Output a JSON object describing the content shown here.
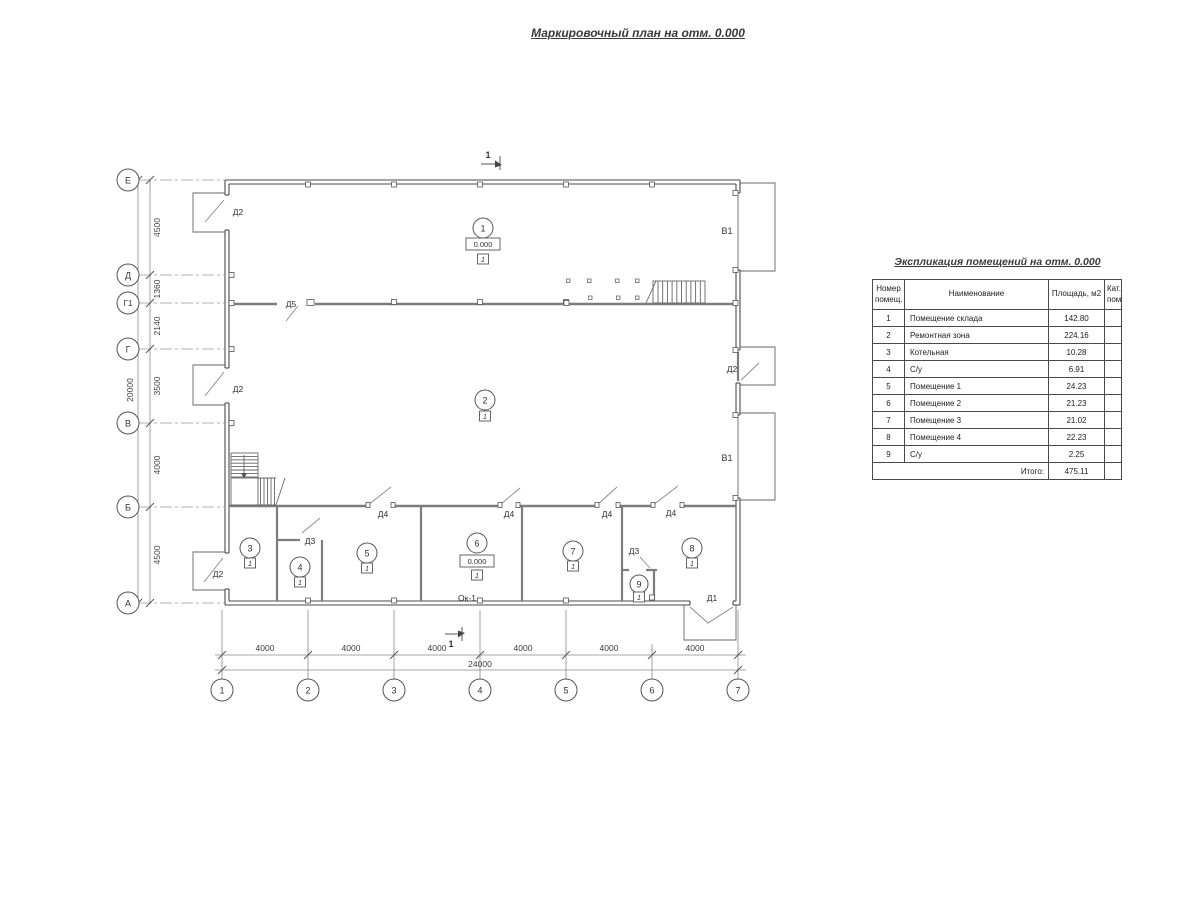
{
  "title": "Маркировочный план на отм. 0.000",
  "plan": {
    "section_mark": "1",
    "row_axes": [
      "Е",
      "Д",
      "Г1",
      "Г",
      "В",
      "Б",
      "А"
    ],
    "row_dims": [
      "4500",
      "1360",
      "2140",
      "3500",
      "4000",
      "4500"
    ],
    "row_total": "20000",
    "col_axes": [
      "1",
      "2",
      "3",
      "4",
      "5",
      "6",
      "7"
    ],
    "col_dims": [
      "4000",
      "4000",
      "4000",
      "4000",
      "4000",
      "4000"
    ],
    "col_total": "24000",
    "rooms": [
      {
        "num": "1",
        "elev": "0.000",
        "cat": "1"
      },
      {
        "num": "2",
        "cat": "1"
      },
      {
        "num": "3",
        "cat": "1"
      },
      {
        "num": "4",
        "cat": "1"
      },
      {
        "num": "5",
        "cat": "1"
      },
      {
        "num": "6",
        "elev": "0.000",
        "cat": "1"
      },
      {
        "num": "7",
        "cat": "1"
      },
      {
        "num": "8",
        "cat": "1"
      },
      {
        "num": "9",
        "cat": "1"
      }
    ],
    "labels": {
      "d1": "Д1",
      "d2": "Д2",
      "d3": "Д3",
      "d4": "Д4",
      "d5": "Д5",
      "v1": "В1",
      "ok1": "Ок-1"
    }
  },
  "table": {
    "title": "Экспликация помещений на отм. 0.000",
    "headers": {
      "num": "Номер помещ.",
      "name": "Наименование",
      "area": "Площадь, м2",
      "cat": "Кат. пом."
    },
    "rows": [
      {
        "num": "1",
        "name": "Помещение склада",
        "area": "142.80"
      },
      {
        "num": "2",
        "name": "Ремонтная зона",
        "area": "224.16"
      },
      {
        "num": "3",
        "name": "Котельная",
        "area": "10.28"
      },
      {
        "num": "4",
        "name": "С/у",
        "area": "6.91"
      },
      {
        "num": "5",
        "name": "Помещение 1",
        "area": "24.23"
      },
      {
        "num": "6",
        "name": "Помещение 2",
        "area": "21.23"
      },
      {
        "num": "7",
        "name": "Помещение 3",
        "area": "21.02"
      },
      {
        "num": "8",
        "name": "Помещение 4",
        "area": "22.23"
      },
      {
        "num": "9",
        "name": "С/у",
        "area": "2.25"
      }
    ],
    "total_label": "Итого:",
    "total": "475.11"
  }
}
